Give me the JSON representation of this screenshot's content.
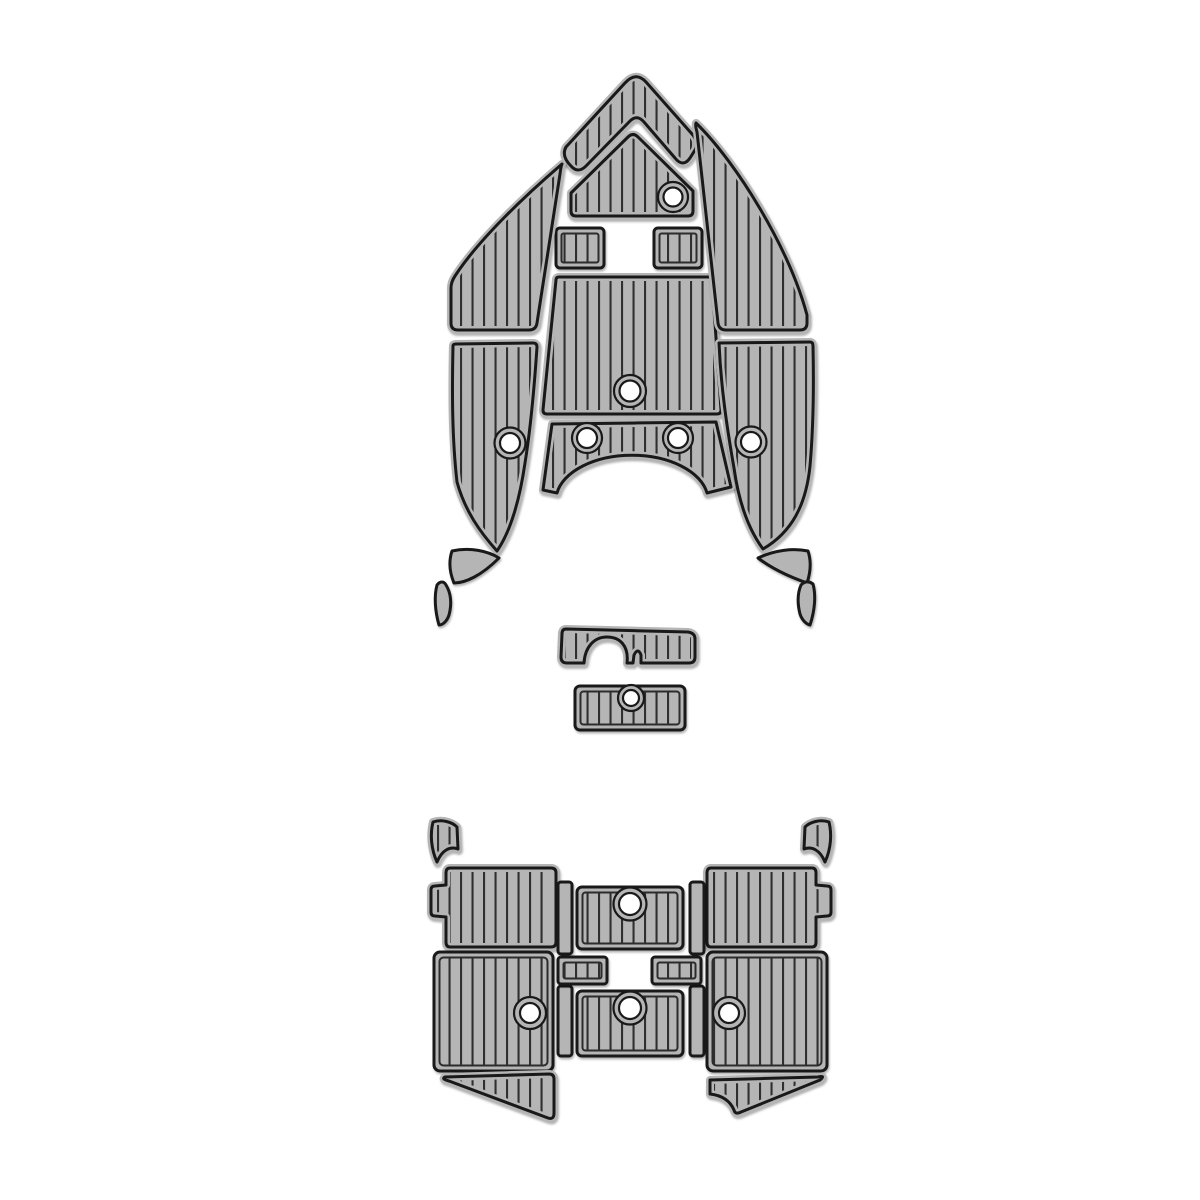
{
  "diagram": {
    "description": "boat-eva-foam-teak-deck-pad-template",
    "canvas": {
      "width": 1200,
      "height": 1200,
      "background": "#ffffff"
    },
    "style": {
      "pad_fill": "#b5b5b5",
      "stripe_color": "#2f2f2f",
      "outline_color": "#191919",
      "inner_line_color": "#2c2c2c",
      "hole_fill": "#ffffff",
      "stripe_spacing": 11.5,
      "stripe_width": 2.2,
      "outline_width": 3,
      "margin_stroke": 8,
      "rect_inset": 5.5
    },
    "pieces": [
      {
        "name": "bow-point-chevron-pad",
        "kind": "path",
        "striped": true,
        "d": "M566,147 L625,83 Q636,71 646,82 L692,134 Q699,142 695,150 L690,158 Q683,168 675,158 L644,122 Q637,114 630,121 L586,166 Q578,174 571,166 Q561,156 566,147 Z"
      },
      {
        "name": "bow-anchor-locker-pad",
        "kind": "path",
        "striped": true,
        "d": "M571,193 L628,137 Q633,132 638,137 L693,191 L693,211 Q693,216 688,216 L576,216 Q571,216 571,211 Z",
        "holes": [
          {
            "cx": 673,
            "cy": 197,
            "ro": 15,
            "ri": 9.5
          }
        ]
      },
      {
        "name": "bow-step-pad-port",
        "kind": "rect",
        "x": 556,
        "y": 228,
        "w": 48,
        "h": 40,
        "rx": 4,
        "striped": true
      },
      {
        "name": "bow-step-pad-starboard",
        "kind": "rect",
        "x": 654,
        "y": 228,
        "w": 48,
        "h": 40,
        "rx": 4,
        "striped": true
      },
      {
        "name": "bow-center-walkway-pad",
        "kind": "path",
        "striped": true,
        "d": "M559,277 L709,277 Q712,277 712,280 L721,410 Q721,414 717,414 L547,414 Q543,414 543,410 L556,280 Q556,277 559,277 Z",
        "holes": [
          {
            "cx": 630,
            "cy": 391,
            "ro": 16,
            "ri": 10.5
          }
        ]
      },
      {
        "name": "bow-port-upper-pad",
        "kind": "path",
        "striped": true,
        "d": "M562,164 C527,194 479,239 455,276 Q451,282 451,288 L451,323 Q451,330 458,330 L529,330 Q536,330 537,323 L560,174 Q561,166 562,164 Z"
      },
      {
        "name": "bow-starboard-upper-pad",
        "kind": "path",
        "striped": true,
        "d": "M696,123 C737,163 789,248 807,315 L807,323 Q807,330 800,330 L726,330 Q719,330 718,323 L697,132 Q695,125 696,123 Z"
      },
      {
        "name": "bow-port-lower-pad",
        "kind": "path",
        "striped": true,
        "d": "M456,344 L533,343 Q537,343 537,347 C534,392 530,432 525,463 C519,504 510,532 497,551 C480,532 465,511 457,482 C452,438 452,392 453,346 Q453,344 456,344 Z",
        "holes": [
          {
            "cx": 510,
            "cy": 443,
            "ro": 15.5,
            "ri": 10
          }
        ]
      },
      {
        "name": "bow-starboard-lower-pad",
        "kind": "path",
        "striped": true,
        "d": "M719,343 L810,342 Q813,342 813,346 C814,392 813,432 810,466 C806,505 792,532 763,549 C749,530 739,504 734,468 C727,428 721,388 719,343 Z",
        "holes": [
          {
            "cx": 751,
            "cy": 442,
            "ro": 15.5,
            "ri": 10
          }
        ]
      },
      {
        "name": "console-arch-pad",
        "kind": "path",
        "striped": true,
        "d": "M543,490 L552,424 L716,422 L731,487 L707,493 A76,45 0 0 0 557,493 Z",
        "holes": [
          {
            "cx": 587,
            "cy": 438,
            "ro": 15,
            "ri": 10
          },
          {
            "cx": 678,
            "cy": 438,
            "ro": 15,
            "ri": 10
          }
        ]
      },
      {
        "name": "bow-port-trim-sliver-1",
        "kind": "path",
        "striped": false,
        "d": "M452,551 C470,547 488,551 499,558 C481,576 465,583 454,583 C449,571 449,560 452,551 Z"
      },
      {
        "name": "bow-port-trim-sliver-2",
        "kind": "path",
        "striped": false,
        "d": "M446,585 C451,593 452,604 449,615 C447,621 443,625 439,625 C435,611 434,596 437,585 C440,581 444,581 446,585 Z"
      },
      {
        "name": "bow-starboard-trim-sliver-1",
        "kind": "path",
        "striped": false,
        "d": "M808,551 C811,560 811,571 807,583 C790,577 771,568 758,558 C775,550 793,548 808,551 Z"
      },
      {
        "name": "bow-starboard-trim-sliver-2",
        "kind": "path",
        "striped": false,
        "d": "M813,584 C816,595 815,610 810,625 C806,624 802,620 800,614 C797,602 798,592 801,585 C805,581 809,581 813,584 Z"
      },
      {
        "name": "seat-base-notched-pad",
        "kind": "path",
        "striped": true,
        "d": "M566,629 L688,632 Q695,633 695,639 L695,657 Q695,663 689,663 L641,663 L641,655 Q638,647 634,655 L633,663 L627,663 C629,646 620,637 607,637 C594,637 585,647 584,663 L567,663 Q561,663 561,657 L562,634 Q562,629 566,629 Z"
      },
      {
        "name": "seat-base-rect-pad",
        "kind": "rect",
        "x": 575,
        "y": 686,
        "w": 110,
        "h": 44,
        "rx": 5,
        "striped": true,
        "holes": [
          {
            "cx": 631,
            "cy": 698,
            "ro": 13,
            "ri": 8
          }
        ]
      },
      {
        "name": "transom-corner-pad-port",
        "kind": "path",
        "striped": true,
        "d": "M433,822 C442,819 452,822 457,827 L458,849 C450,846 442,850 437,862 C431,849 430,834 433,822 Z"
      },
      {
        "name": "transom-corner-pad-starboard",
        "kind": "path",
        "striped": true,
        "d": "M829,822 C820,819 810,822 805,827 L804,849 C812,846 820,850 825,862 C831,849 832,834 829,822 Z"
      },
      {
        "name": "cockpit-port-upper-pad",
        "kind": "path",
        "striped": true,
        "d": "M450,868 L551,868 Q556,868 556,873 L556,942 Q556,947 551,947 L450,947 Q446,947 446,942 L446,917 L435,916 Q431,916 431,912 L431,890 Q431,886 435,886 L446,885 L446,873 Q446,868 450,868 Z"
      },
      {
        "name": "cockpit-starboard-upper-pad",
        "kind": "path",
        "striped": true,
        "d": "M711,868 L812,868 Q816,868 816,873 L816,885 L827,886 Q831,886 831,890 L831,912 Q831,916 827,916 L816,917 L816,942 Q816,947 812,947 L711,947 Q707,947 707,942 L707,873 Q707,868 711,868 Z"
      },
      {
        "name": "cockpit-batten-port-upper",
        "kind": "rect",
        "x": 558,
        "y": 882,
        "w": 14,
        "h": 72,
        "rx": 3,
        "striped": false
      },
      {
        "name": "cockpit-batten-starboard-upper",
        "kind": "rect",
        "x": 690,
        "y": 882,
        "w": 14,
        "h": 72,
        "rx": 3,
        "striped": false
      },
      {
        "name": "cockpit-batten-port-lower",
        "kind": "rect",
        "x": 558,
        "y": 986,
        "w": 14,
        "h": 70,
        "rx": 3,
        "striped": false
      },
      {
        "name": "cockpit-batten-starboard-lower",
        "kind": "rect",
        "x": 690,
        "y": 986,
        "w": 14,
        "h": 70,
        "rx": 3,
        "striped": false
      },
      {
        "name": "cockpit-center-upper-pad",
        "kind": "rect",
        "x": 577,
        "y": 887,
        "w": 106,
        "h": 62,
        "rx": 5,
        "striped": true,
        "holes": [
          {
            "cx": 630,
            "cy": 904,
            "ro": 16.5,
            "ri": 11
          }
        ]
      },
      {
        "name": "cockpit-center-lower-pad",
        "kind": "rect",
        "x": 577,
        "y": 991,
        "w": 106,
        "h": 65,
        "rx": 5,
        "striped": true,
        "holes": [
          {
            "cx": 630,
            "cy": 1008,
            "ro": 16.5,
            "ri": 11
          }
        ]
      },
      {
        "name": "hatch-step-pad-port",
        "kind": "rect",
        "x": 558,
        "y": 957,
        "w": 49,
        "h": 27,
        "rx": 3,
        "striped": true
      },
      {
        "name": "hatch-step-pad-starboard",
        "kind": "rect",
        "x": 652,
        "y": 957,
        "w": 49,
        "h": 27,
        "rx": 3,
        "striped": true
      },
      {
        "name": "cockpit-port-lower-pad",
        "kind": "rect",
        "x": 434,
        "y": 952,
        "w": 119,
        "h": 119,
        "rx": 6,
        "striped": true,
        "holes": [
          {
            "cx": 530,
            "cy": 1013,
            "ro": 16,
            "ri": 10
          }
        ]
      },
      {
        "name": "cockpit-starboard-lower-pad",
        "kind": "rect",
        "x": 707,
        "y": 952,
        "w": 120,
        "h": 119,
        "rx": 6,
        "striped": true,
        "holes": [
          {
            "cx": 729,
            "cy": 1013,
            "ro": 16,
            "ri": 10
          }
        ]
      },
      {
        "name": "swim-step-wedge-port",
        "kind": "path",
        "striped": true,
        "d": "M445,1077 L549,1074 Q554,1074 554,1079 L554,1113 Q554,1120 548,1118 L449,1081 Q441,1079 445,1077 Z"
      },
      {
        "name": "swim-step-wedge-starboard",
        "kind": "path",
        "striped": true,
        "d": "M710,1080 L818,1077 Q826,1075 820,1080 L741,1112 Q735,1115 734,1110 Q728,1096 710,1094 Z"
      }
    ]
  }
}
